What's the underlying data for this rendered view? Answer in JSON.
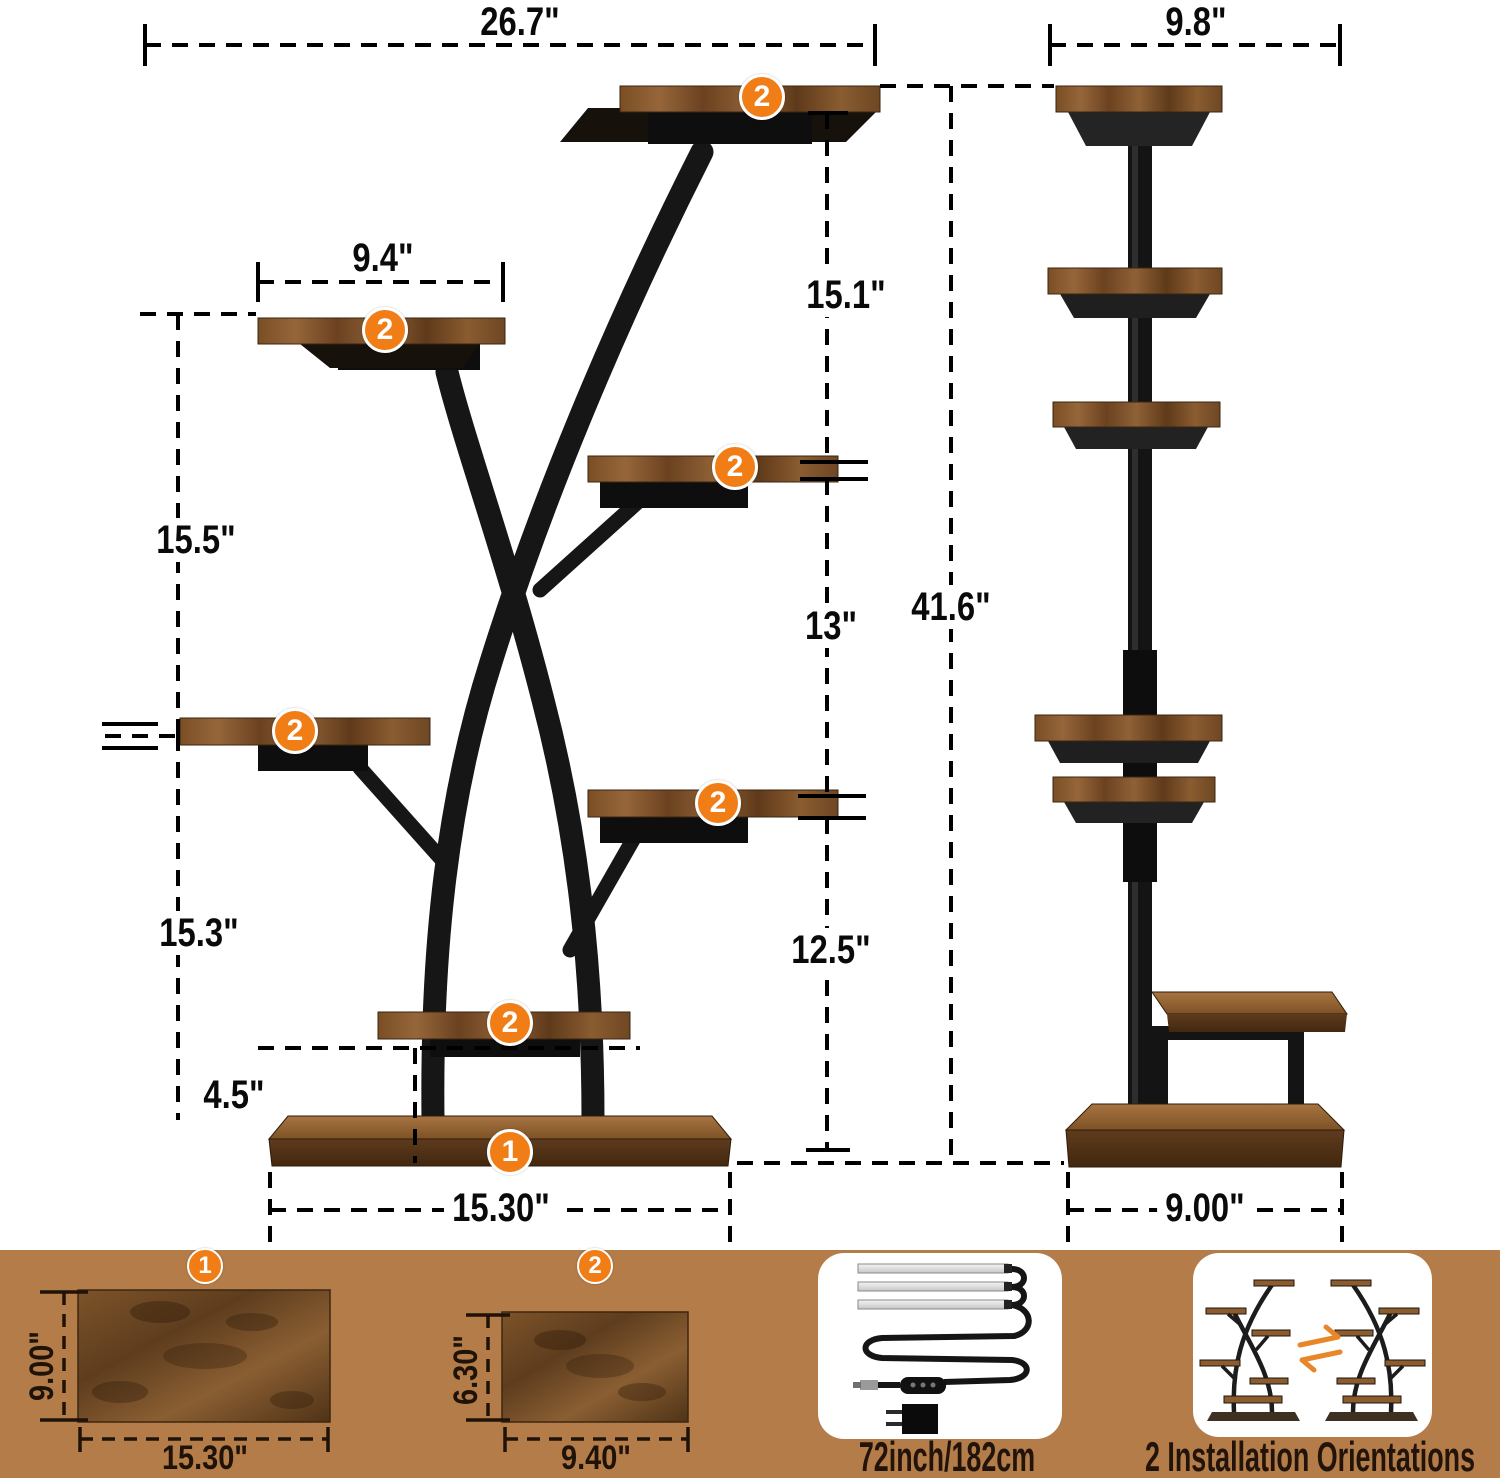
{
  "front_view": {
    "shelf_badge": "2",
    "base_badge": "1",
    "overall_width": "26.7\"",
    "shelf_width": "9.4\"",
    "top_to_middle_height": "15.1\"",
    "left_upper_height": "15.5\"",
    "middle_height": "13\"",
    "overall_height": "41.6\"",
    "left_lower_height": "15.3\"",
    "right_lower_height": "12.5\"",
    "base_shelf_height": "4.5\"",
    "base_width": "15.30\""
  },
  "side_view": {
    "top_depth": "9.8\"",
    "base_depth": "9.00\""
  },
  "legend": {
    "board_large": {
      "badge": "1",
      "depth": "9.00\"",
      "width": "15.30\""
    },
    "board_small": {
      "badge": "2",
      "depth": "6.30\"",
      "width": "9.40\""
    },
    "grow_light": {
      "label": "72inch/182cm"
    },
    "orientations": {
      "label": "2 Installation Orientations"
    }
  },
  "colors": {
    "band": "#b47c48",
    "accent": "#f07d15",
    "metal": "#161616"
  }
}
